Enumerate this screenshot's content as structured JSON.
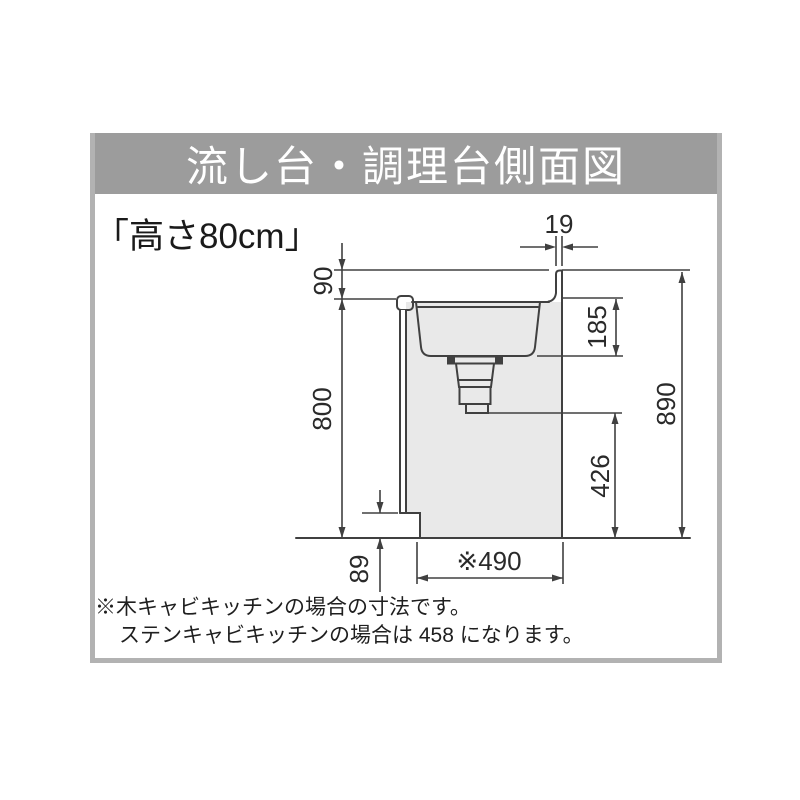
{
  "title_bar": {
    "title": "流し台・調理台側面図"
  },
  "subtitle": "「高さ80cm」",
  "diagram": {
    "dim_backsplash_thickness": "19",
    "dim_backsplash_height": "90",
    "dim_counter_height": "800",
    "dim_sink_depth": "185",
    "dim_drain_to_floor": "426",
    "dim_total_height": "890",
    "dim_toe_kick_height": "89",
    "dim_cabinet_depth": "※490"
  },
  "notes": {
    "line1": "※木キャビキッチンの場合の寸法です。",
    "line2": "ステンキャビキッチンの場合は 458 になります。"
  },
  "colors": {
    "title_bar_bg": "#9c9c9c",
    "title_text": "#ffffff",
    "frame_border": "#b2b2b2",
    "cabinet_fill": "#e9e9e9",
    "line": "#404040",
    "text": "#1f1f1f"
  }
}
